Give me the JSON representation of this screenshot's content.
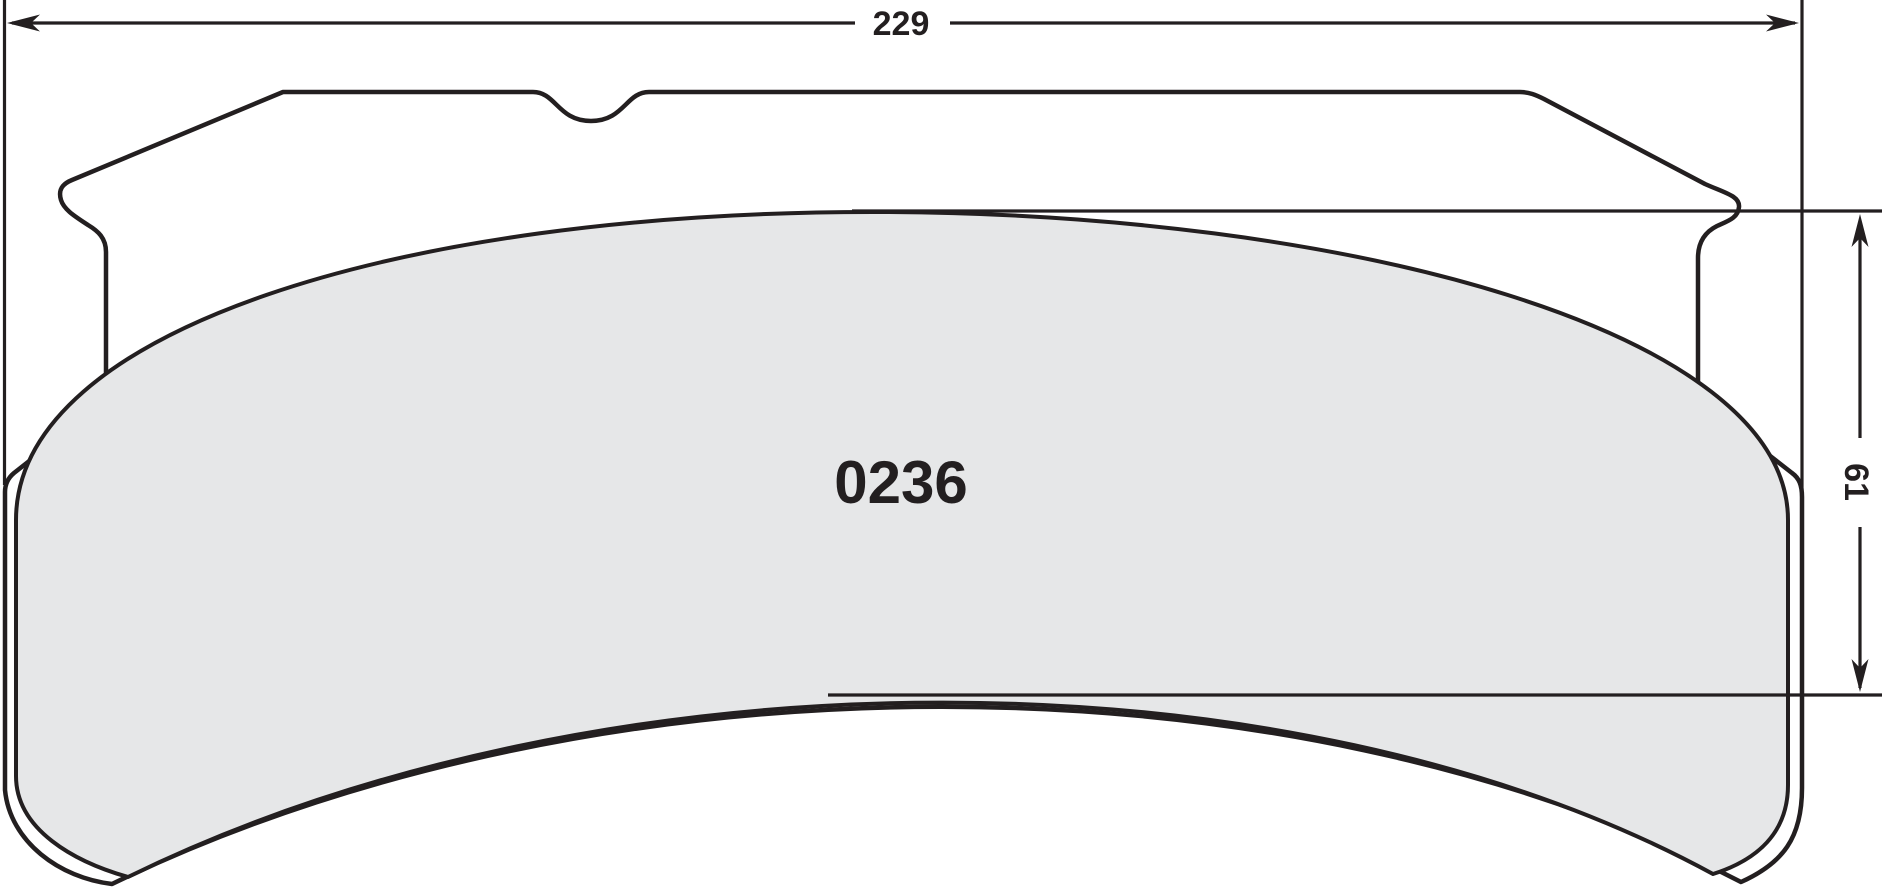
{
  "drawing": {
    "type": "brake-pad-dimension-drawing",
    "part_number": "0236",
    "width_dimension": {
      "value": "229",
      "orientation": "horizontal",
      "location": "top"
    },
    "height_dimension": {
      "value": "61",
      "orientation": "vertical",
      "location": "right"
    }
  },
  "colors": {
    "line": "#231f20",
    "pad_fill": "#e6e7e8",
    "backplate_fill": "#ffffff",
    "background": "#ffffff"
  },
  "icons": {
    "arrows": [
      "arrow-left-icon",
      "arrow-right-icon",
      "arrow-up-icon",
      "arrow-down-icon"
    ]
  }
}
